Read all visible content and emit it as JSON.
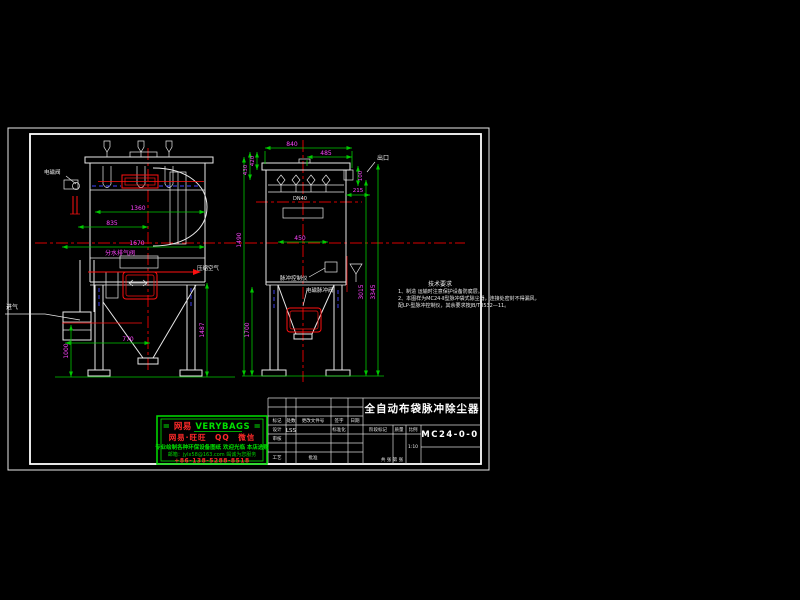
{
  "app": {
    "type": "cad-drawing-viewer",
    "background": "#000000"
  },
  "colors": {
    "outline": "#e8e8e8",
    "centerline_red": "#d80000",
    "detail_red": "#ff1010",
    "hidden_blue": "#4444ff",
    "dimension_green": "#00c800",
    "dimension_text_magenta": "#ff44ff",
    "watermark_green": "#00e000",
    "watermark_red": "#ff2a2a"
  },
  "front_view": {
    "labels": {
      "solenoid_valve": "电磁阀",
      "drain_vent_valve": "分水排气阀",
      "compressed_air": "压缩空气",
      "inlet": "进气"
    },
    "dimensions": {
      "width_top": "1360",
      "width_mid": "835",
      "width_total": "1670",
      "hopper_width": "770",
      "inlet_height": "1000",
      "leg_height": "1487"
    }
  },
  "side_view": {
    "labels": {
      "outlet": "出口",
      "pulse_controller": "脉冲控制仪",
      "pulse_valve": "电磁脉冲阀",
      "pipe_spec": "DN40"
    },
    "dimensions": {
      "width_top": "840",
      "width_upper": "485",
      "h_top_left_1": "420",
      "h_top_left_2": "430",
      "h_outlet": "100",
      "w_outlet": "215",
      "door_width": "450",
      "h_left_total": "1490",
      "h_hopper_leg": "1700",
      "h_right_inner": "3015",
      "h_right_outer": "3345"
    }
  },
  "notes": {
    "heading": "技术要求",
    "line1": "1、制造 运输时注意保护设备防腐层。",
    "line2": "2、本图样为MC24-Ⅱ型脉冲袋式除尘器，连接处密封不得漏风，",
    "line3": "配LP-型脉冲控制仪，其余要求按JB/T8532—11。"
  },
  "title_block": {
    "drawing_title": "全自动布袋脉冲除尘器",
    "drawing_number": "MC24-0-0",
    "col_mark": "标记",
    "col_count": "处数",
    "col_doc": "更改文件号",
    "col_sign": "签字",
    "col_date": "日期",
    "design_label": "设计",
    "design_value": "LSS",
    "standard_label": "标准化",
    "check_label": "审核",
    "process_label": "工艺",
    "approve_label": "批准",
    "stage_label": "阶段标记",
    "weight_label": "质量",
    "scale_label": "比例",
    "scale_value": "1:10",
    "sheet_info": "共 张 第 张"
  },
  "watermark": {
    "l1_prefix": "= ",
    "l1_brand": "网易",
    "l1_suffix": " VERYBAGS =",
    "l2": "网易·旺旺　QQ　微信",
    "l3": "专业绘制各种环保设备图纸 欢迎光临 本店选购",
    "l4": "邮箱：jylx58@163.com 竭诚为您服务",
    "l5": "+86-138-5288-8518"
  }
}
